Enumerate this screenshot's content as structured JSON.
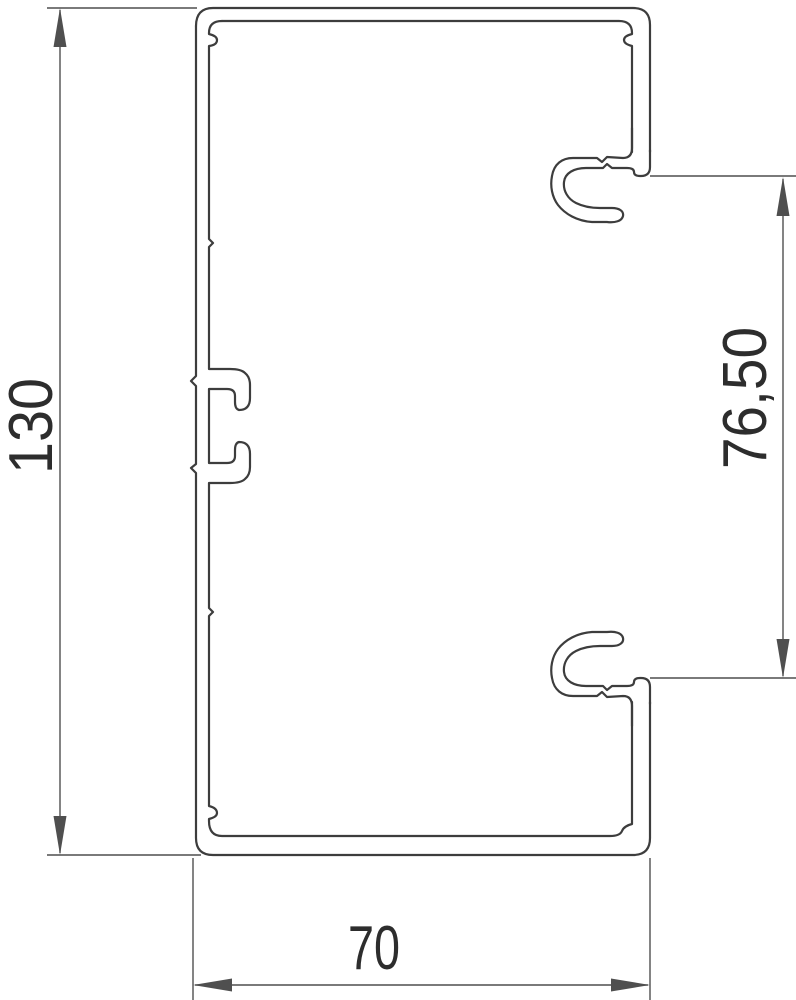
{
  "drawing": {
    "dimensions": {
      "height_label": "130",
      "opening_label": "76,50",
      "width_label": "70"
    },
    "colors": {
      "profile_line": "#3d3d3d",
      "dimension_line": "#4f4f4f",
      "text": "#2d2d2d",
      "background": "#ffffff"
    }
  }
}
